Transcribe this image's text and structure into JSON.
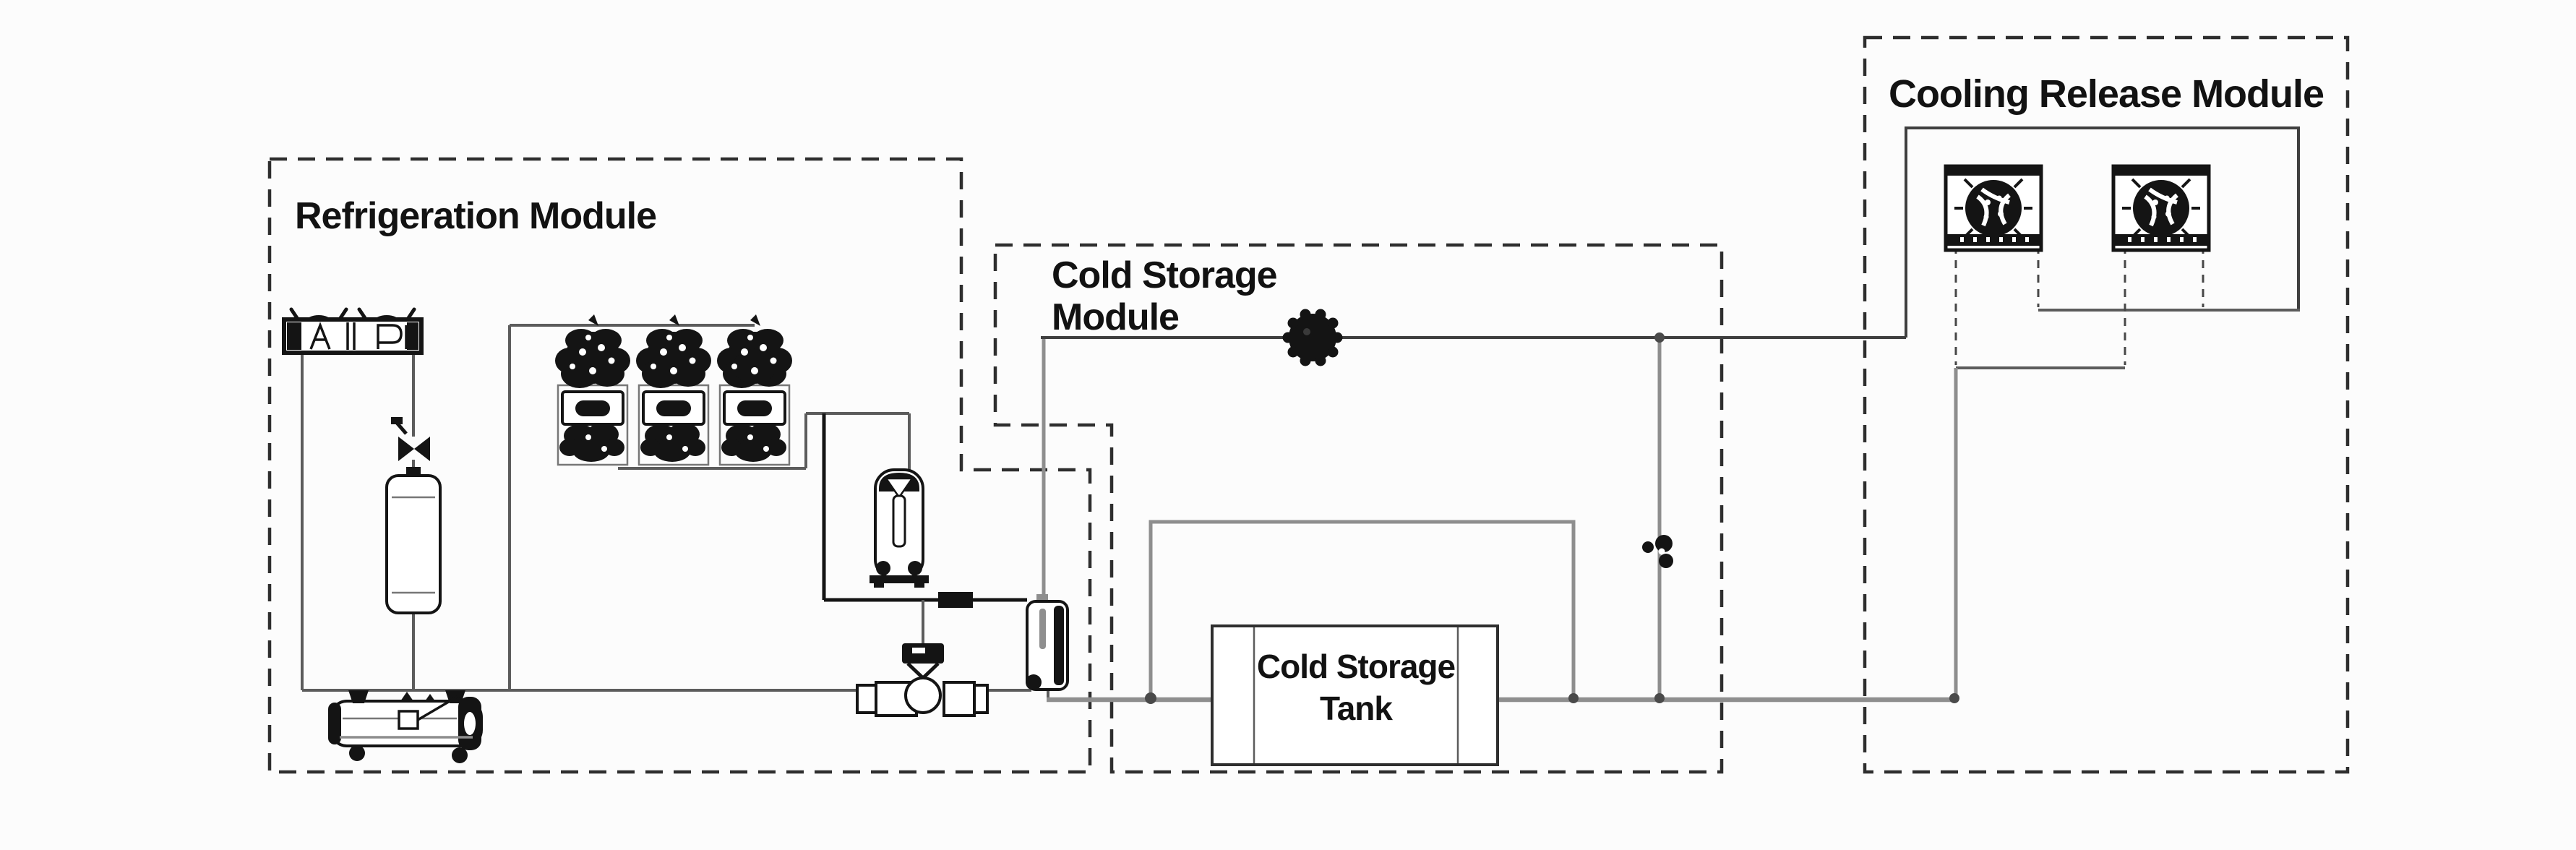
{
  "modules": {
    "refrigeration": {
      "title": "Refrigeration Module"
    },
    "cold_storage": {
      "title_line1": "Cold Storage",
      "title_line2": "Module"
    },
    "cooling_release": {
      "title": "Cooling Release Module"
    },
    "cold_storage_tank": {
      "label_line1": "Cold Storage",
      "label_line2": "Tank"
    }
  },
  "components": {
    "air_cooled_condenser": "air-cooled-condenser-icon",
    "compressor_rack": [
      "compressor-icon",
      "compressor-icon",
      "compressor-icon"
    ],
    "oil_separator": "oil-separator-icon",
    "vertical_receiver": "vertical-receiver-icon",
    "horizontal_receiver": "horizontal-receiver-icon",
    "shutoff_valve": "shutoff-valve-icon",
    "filter_drier": "filter-drier-icon",
    "expansion_valve": "expansion-valve-icon",
    "plate_evaporator": "plate-evaporator-icon",
    "circulation_pump": "pump-icon",
    "bypass_valve": "bypass-valve-icon",
    "air_cooler_fans": [
      "air-cooler-fan-icon",
      "air-cooler-fan-icon"
    ]
  },
  "colors": {
    "background": "#fcfcfc",
    "module_border": "#2e2e2e",
    "title_text": "#121212",
    "pipe_dark": "#3f3f3f",
    "pipe_mid": "#5c5c5c",
    "pipe_gray": "#8e8e8e",
    "component_black": "#141414"
  }
}
